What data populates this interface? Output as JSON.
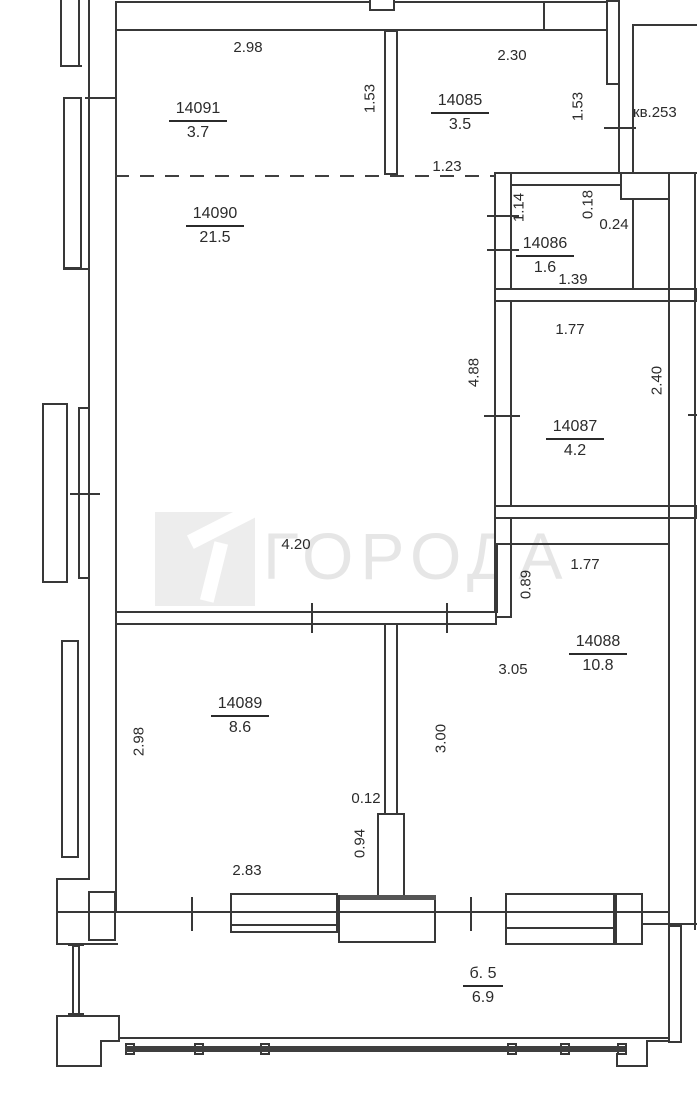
{
  "watermark": {
    "text": "ГОРОДА",
    "logo_color": "#ededed",
    "text_color": "#e6e6e6"
  },
  "neighbor": {
    "label": "кв.253"
  },
  "rooms": {
    "r14091": {
      "id": "14091",
      "area": "3.7"
    },
    "r14085": {
      "id": "14085",
      "area": "3.5"
    },
    "r14090": {
      "id": "14090",
      "area": "21.5"
    },
    "r14086": {
      "id": "14086",
      "area": "1.6"
    },
    "r14087": {
      "id": "14087",
      "area": "4.2"
    },
    "r14088": {
      "id": "14088",
      "area": "10.8"
    },
    "r14089": {
      "id": "14089",
      "area": "8.6"
    },
    "balcony": {
      "id": "б. 5",
      "area": "6.9"
    }
  },
  "dims": {
    "w14091_top": "2.98",
    "partition_14091_14085": "1.53",
    "w14085_top": "2.30",
    "w14085_right": "1.53",
    "hall_opening": "1.23",
    "c14086_left": "1.14",
    "c14086_a": "0.18",
    "c14086_b": "0.24",
    "c14086_width": "1.39",
    "c14087_top": "1.77",
    "c14087_right": "2.40",
    "c14090_right": "4.88",
    "c14090_bottom": "4.20",
    "c14088_notch": "0.89",
    "c14088_top": "1.77",
    "c14088_left": "3.05",
    "partition_length": "3.00",
    "c14089_left": "2.98",
    "partition_thickness": "0.12",
    "partition_bottom": "0.94",
    "w14089_window": "2.83"
  }
}
